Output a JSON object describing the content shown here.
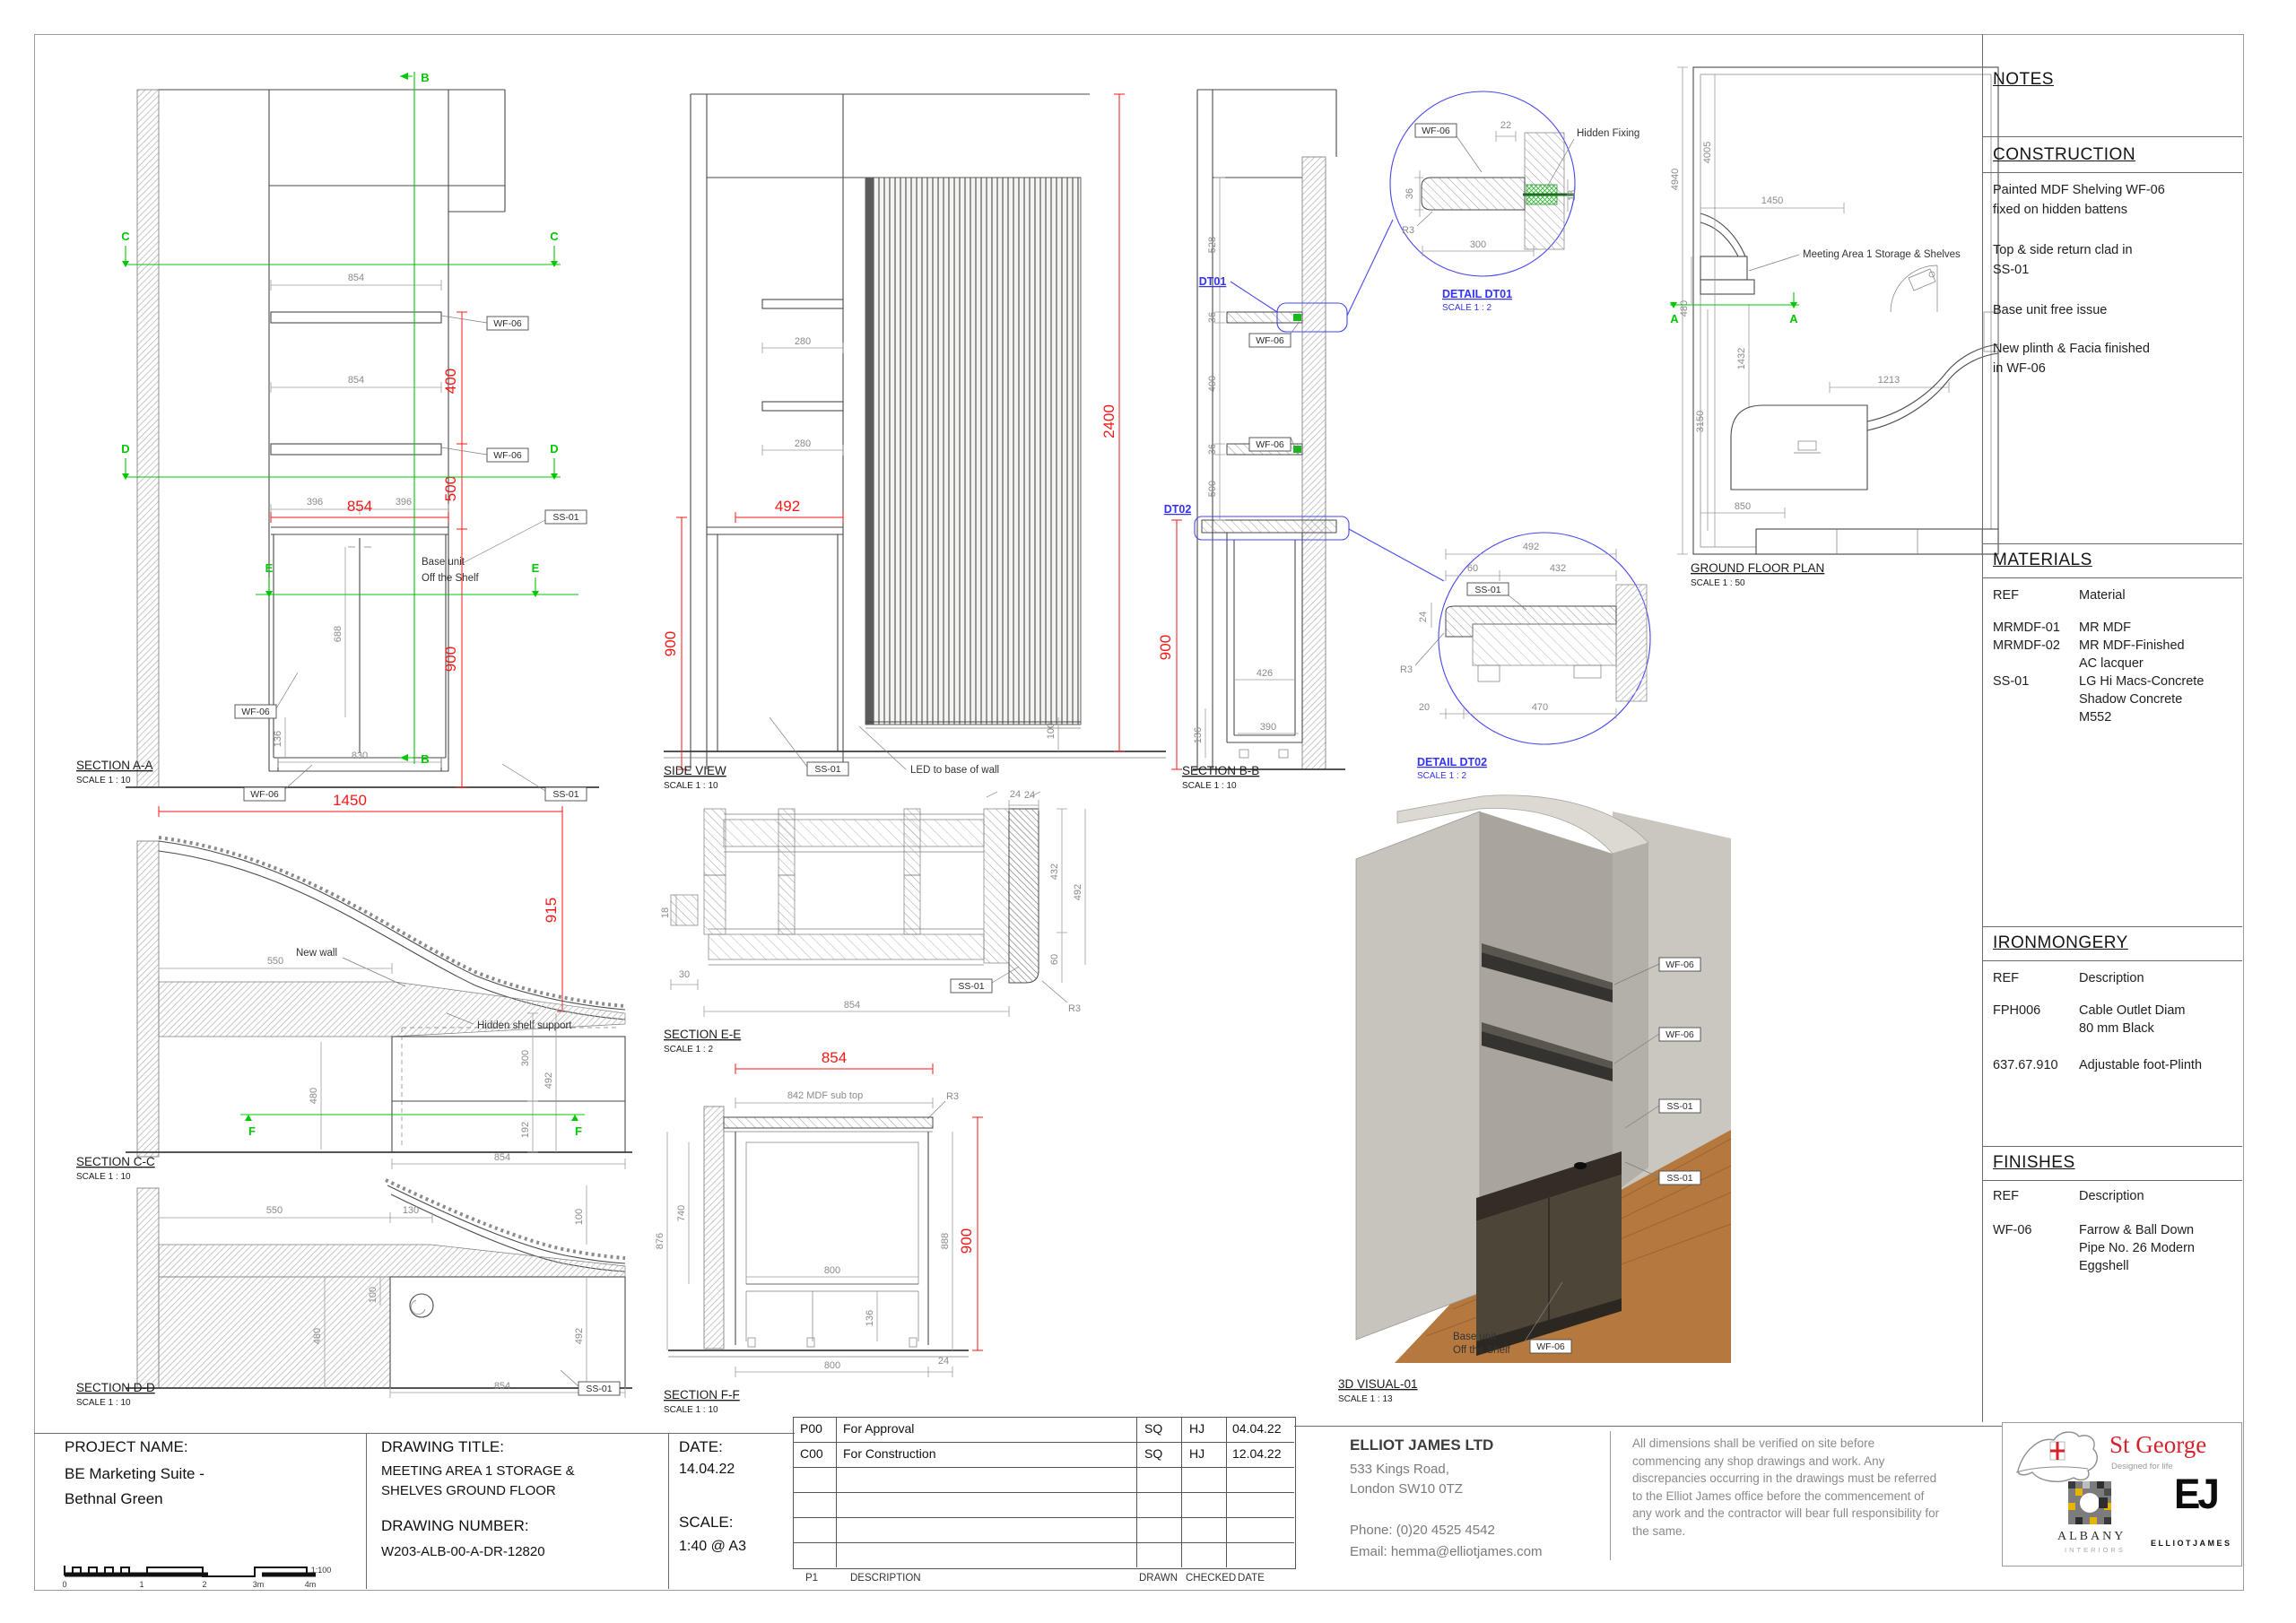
{
  "panel": {
    "notes_title": "NOTES",
    "construction": {
      "title": "CONSTRUCTION",
      "notes": [
        [
          "Painted MDF Shelving WF-06",
          "fixed on hidden battens"
        ],
        [
          "Top & side return clad in",
          "SS-01"
        ],
        [
          "Base unit free issue"
        ],
        [
          "New plinth & Facia finished",
          "in WF-06"
        ]
      ]
    },
    "materials": {
      "title": "MATERIALS",
      "col_ref": "REF",
      "col_desc": "Material",
      "rows": [
        {
          "ref": "MRMDF-01",
          "lines": [
            "MR MDF"
          ]
        },
        {
          "ref": "MRMDF-02",
          "lines": [
            "MR MDF-Finished",
            "AC lacquer"
          ]
        },
        {
          "ref": "SS-01",
          "lines": [
            "LG Hi Macs-Concrete",
            "Shadow Concrete",
            "M552"
          ]
        }
      ]
    },
    "ironmongery": {
      "title": "IRONMONGERY",
      "col_ref": "REF",
      "col_desc": "Description",
      "rows": [
        {
          "ref": "FPH006",
          "lines": [
            "Cable Outlet Diam",
            "80 mm Black"
          ]
        },
        {
          "ref": "637.67.910",
          "lines": [
            "Adjustable foot-Plinth"
          ]
        }
      ]
    },
    "finishes": {
      "title": "FINISHES",
      "col_ref": "REF",
      "col_desc": "Description",
      "rows": [
        {
          "ref": "WF-06",
          "lines": [
            "Farrow & Ball Down",
            "Pipe No. 26 Modern",
            "Eggshell"
          ]
        }
      ]
    }
  },
  "titleblock": {
    "project_label": "PROJECT NAME:",
    "project_name": [
      "BE Marketing Suite -",
      "Bethnal Green"
    ],
    "scalebar": {
      "t0": "0",
      "t1": "1",
      "t2": "2",
      "t3": "3m",
      "t4": "4m",
      "ratio": "1:100"
    },
    "title_label": "DRAWING TITLE:",
    "drawing_title": [
      "MEETING AREA 1 STORAGE &",
      "SHELVES GROUND FLOOR"
    ],
    "number_label": "DRAWING NUMBER:",
    "drawing_number": "W203-ALB-00-A-DR-12820",
    "date_label": "DATE:",
    "date": "14.04.22",
    "scale_label": "SCALE:",
    "scale": "1:40 @ A3",
    "revisions": {
      "rows": [
        {
          "rev": "P00",
          "desc": "For Approval",
          "drawn": "SQ",
          "checked": "HJ",
          "date": "04.04.22"
        },
        {
          "rev": "C00",
          "desc": "For Construction",
          "drawn": "SQ",
          "checked": "HJ",
          "date": "12.04.22"
        }
      ],
      "footer": {
        "rev": "P1",
        "desc": "DESCRIPTION",
        "drawn": "DRAWN",
        "checked": "CHECKED",
        "date": "DATE"
      }
    },
    "company": {
      "name": "ELLIOT JAMES LTD",
      "address": [
        "533 Kings Road,",
        "London SW10 0TZ"
      ],
      "phone": "Phone: (0)20 4525 4542",
      "email": "Email: hemma@elliotjames.com"
    },
    "disclaimer": "All dimensions shall be verified on site before commencing any shop drawings and work. Any discrepancies occurring in the drawings must be referred to the Elliot James office before the commencement of any work and the contractor will bear full responsibility for the same.",
    "logos": {
      "stgeorge_name": "St George",
      "stgeorge_tagline": "Designed for life",
      "albany_name": "ALBANY",
      "albany_sub": "INTERIORS",
      "ej_monogram": "EJ",
      "ej_name": "ELLIOTJAMES"
    }
  },
  "drawing": {
    "markers": {
      "a": "A",
      "b": "B",
      "c": "C",
      "d": "D",
      "e": "E",
      "f": "F"
    },
    "tags": {
      "wf06": "WF-06",
      "ss01": "SS-01",
      "r3": "R3",
      "dt01": "DT01",
      "dt02": "DT02"
    },
    "dims": {
      "d18": "18",
      "d20": "20",
      "d22": "22",
      "d24": "24",
      "d30": "30",
      "d36": "36",
      "d60": "60",
      "d100": "100",
      "d130": "130",
      "d136": "136",
      "d192": "192",
      "d280": "280",
      "d300": "300",
      "d390": "390",
      "d396": "396",
      "d400": "400",
      "d426": "426",
      "d432": "432",
      "d470": "470",
      "d480": "480",
      "d492": "492",
      "d500": "500",
      "d528": "528",
      "d550": "550",
      "d688": "688",
      "d740": "740",
      "d800": "800",
      "d830": "830",
      "d842": "842 MDF sub top",
      "d850": "850",
      "d854": "854",
      "d876": "876",
      "d888": "888",
      "d900": "900",
      "d915": "915",
      "d1213": "1213",
      "d1432": "1432",
      "d1450": "1450",
      "d2400": "2400",
      "d3150": "3150",
      "d4005": "4005",
      "d4940": "4940"
    },
    "views": {
      "section_aa": {
        "title": "SECTION A-A",
        "scale": "SCALE 1 : 10",
        "base_unit": [
          "Base unit",
          "Off the Shelf"
        ]
      },
      "side_view": {
        "title": "SIDE VIEW",
        "scale": "SCALE 1 : 10",
        "led_note": "LED to base of wall"
      },
      "section_bb": {
        "title": "SECTION B-B",
        "scale": "SCALE 1 : 10"
      },
      "detail_dt01": {
        "title": "DETAIL DT01",
        "scale": "SCALE 1 : 2",
        "hidden_fixing": "Hidden Fixing"
      },
      "detail_dt02": {
        "title": "DETAIL DT02",
        "scale": "SCALE 1 : 2"
      },
      "ground_floor_plan": {
        "title": "GROUND FLOOR PLAN",
        "scale": "SCALE 1 : 50",
        "annotation": "Meeting Area 1 Storage & Shelves"
      },
      "section_cc": {
        "title": "SECTION C-C",
        "scale": "SCALE 1 : 10",
        "new_wall": "New wall",
        "hidden_shelf": "Hidden shelf support"
      },
      "section_dd": {
        "title": "SECTION D-D",
        "scale": "SCALE 1 : 10"
      },
      "section_ee": {
        "title": "SECTION E-E",
        "scale": "SCALE 1 : 2"
      },
      "section_ff": {
        "title": "SECTION F-F",
        "scale": "SCALE 1 : 10"
      },
      "visual_3d": {
        "title": "3D VISUAL-01",
        "scale": "SCALE 1 : 13",
        "base_unit": [
          "Base unit",
          "Off the Shelf"
        ]
      }
    }
  }
}
